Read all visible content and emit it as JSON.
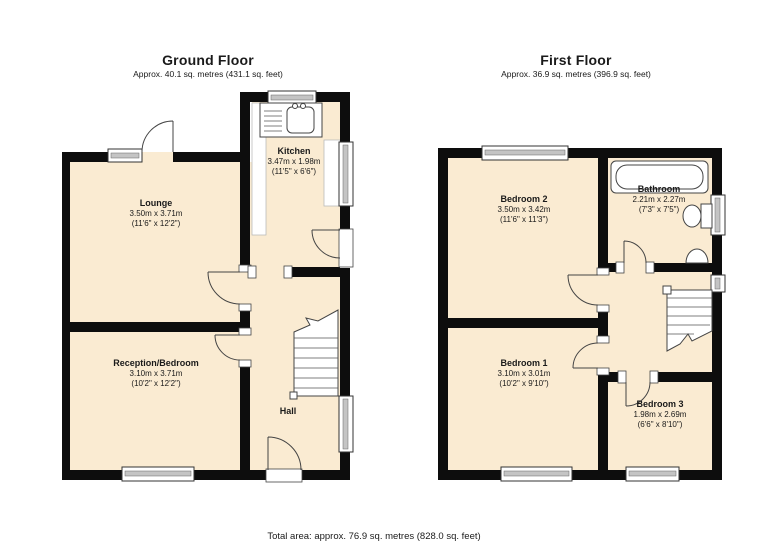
{
  "ground_floor": {
    "title": "Ground Floor",
    "subtitle": "Approx. 40.1 sq. metres (431.1 sq. feet)",
    "rooms": {
      "lounge": {
        "name": "Lounge",
        "metric": "3.50m x 3.71m",
        "imperial": "(11'6\" x 12'2\")"
      },
      "kitchen": {
        "name": "Kitchen",
        "metric": "3.47m x 1.98m",
        "imperial": "(11'5\" x 6'6\")"
      },
      "reception": {
        "name": "Reception/Bedroom",
        "metric": "3.10m x 3.71m",
        "imperial": "(10'2\" x 12'2\")"
      },
      "hall": {
        "name": "Hall"
      }
    }
  },
  "first_floor": {
    "title": "First Floor",
    "subtitle": "Approx. 36.9 sq. metres (396.9 sq. feet)",
    "rooms": {
      "bedroom2": {
        "name": "Bedroom 2",
        "metric": "3.50m x 3.42m",
        "imperial": "(11'6\" x 11'3\")"
      },
      "bathroom": {
        "name": "Bathroom",
        "metric": "2.21m x 2.27m",
        "imperial": "(7'3\" x 7'5\")"
      },
      "bedroom1": {
        "name": "Bedroom 1",
        "metric": "3.10m x 3.01m",
        "imperial": "(10'2\" x 9'10\")"
      },
      "bedroom3": {
        "name": "Bedroom 3",
        "metric": "1.98m x 2.69m",
        "imperial": "(6'6\" x 8'10\")"
      }
    }
  },
  "footer": {
    "total_area": "Total area: approx.  76.9 sq. metres (828.0 sq. feet)"
  },
  "colors": {
    "floor_fill": "#FAEBD2",
    "wall": "#0d0d0d",
    "fixture_outline": "#444444"
  }
}
